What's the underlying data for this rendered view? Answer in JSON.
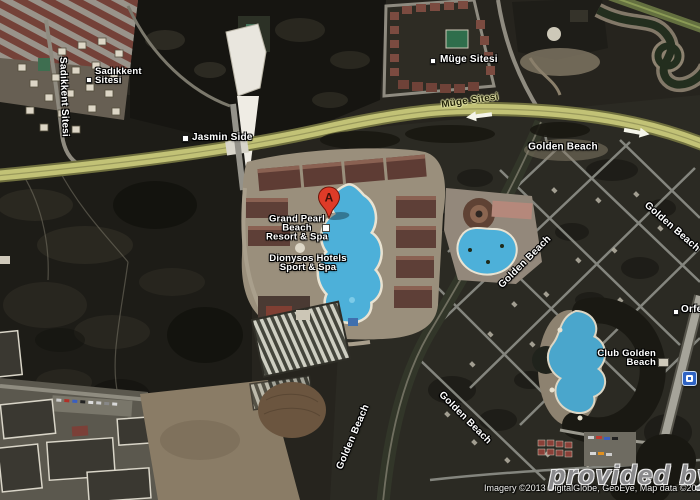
{
  "map": {
    "street_labels": {
      "sadikkent_sitesi": "Sadıkkent Sitesi",
      "muge_sitesi_road": "Müge Sitesi",
      "golden_beach": "Golden Beach"
    },
    "poi_labels": {
      "sadikkent": {
        "line1": "Sadıkkent",
        "line2": "Sitesi"
      },
      "muge_sitesi": "Müge Sitesi",
      "jasmin_side": "Jasmin Side",
      "grand_pearl": {
        "line1": "Grand Pearl",
        "line2": "Beach",
        "line3": "Resort & Spa"
      },
      "dionysos": {
        "line1": "Dionysos Hotels",
        "line2": "Sport & Spa"
      },
      "club_golden": {
        "line1": "Club Golden",
        "line2": "Beach"
      },
      "orfeus": "Orfeus"
    },
    "marker_a": {
      "letter": "A",
      "pin_color": "#de3b28"
    },
    "icons": {
      "transit_stop": "bus-stop",
      "poi_dot": "white-square",
      "lodging": "building"
    },
    "watermark": "provided by Le",
    "attribution": "Imagery ©2013 DigitalGlobe, GeoEye, Map data ©2013",
    "colors": {
      "highway": "#c2c276",
      "pool_water": "#4db0d9",
      "terrain_dark": "#1d1c17",
      "label_halo": "#000000"
    }
  }
}
